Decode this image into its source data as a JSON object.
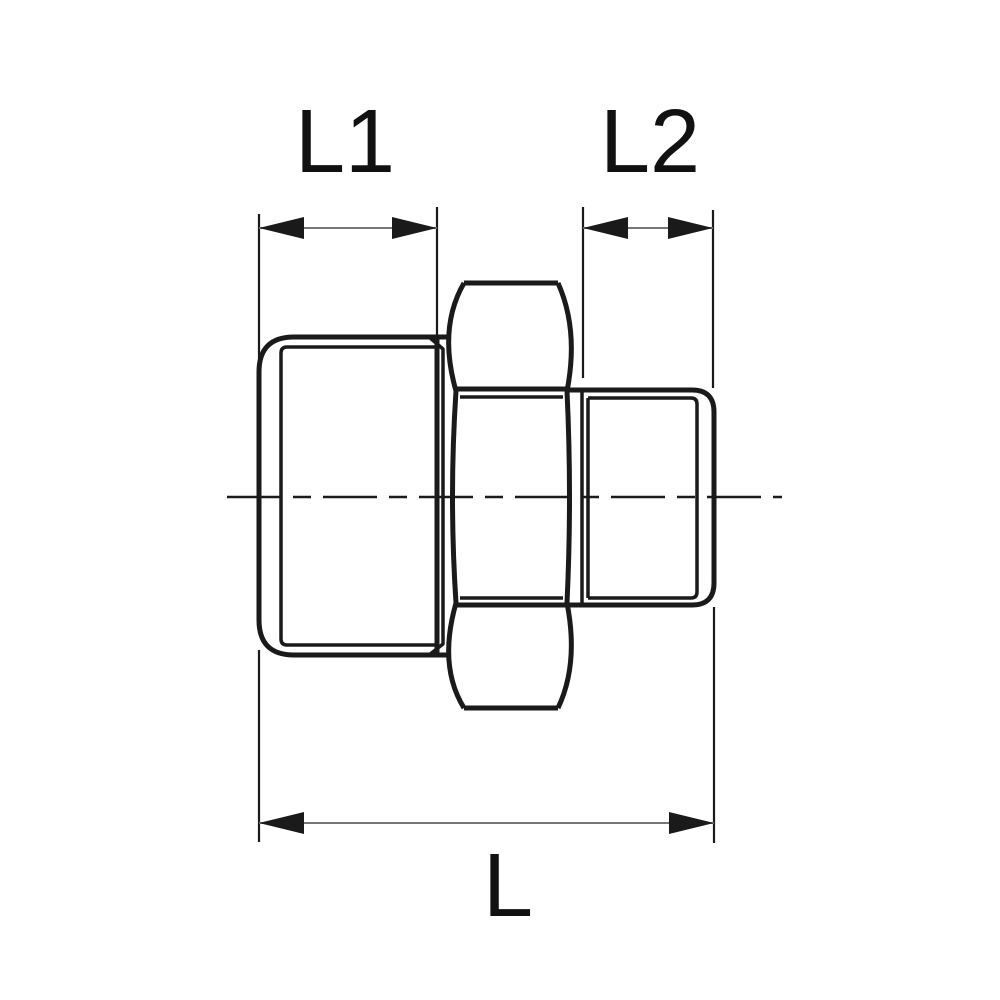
{
  "labels": {
    "l1": "L1",
    "l2": "L2",
    "l": "L"
  },
  "colors": {
    "background": "#ffffff",
    "part_line": "#1a1a1a",
    "dimension_connector_line": "#777777",
    "label_text": "#111111"
  }
}
